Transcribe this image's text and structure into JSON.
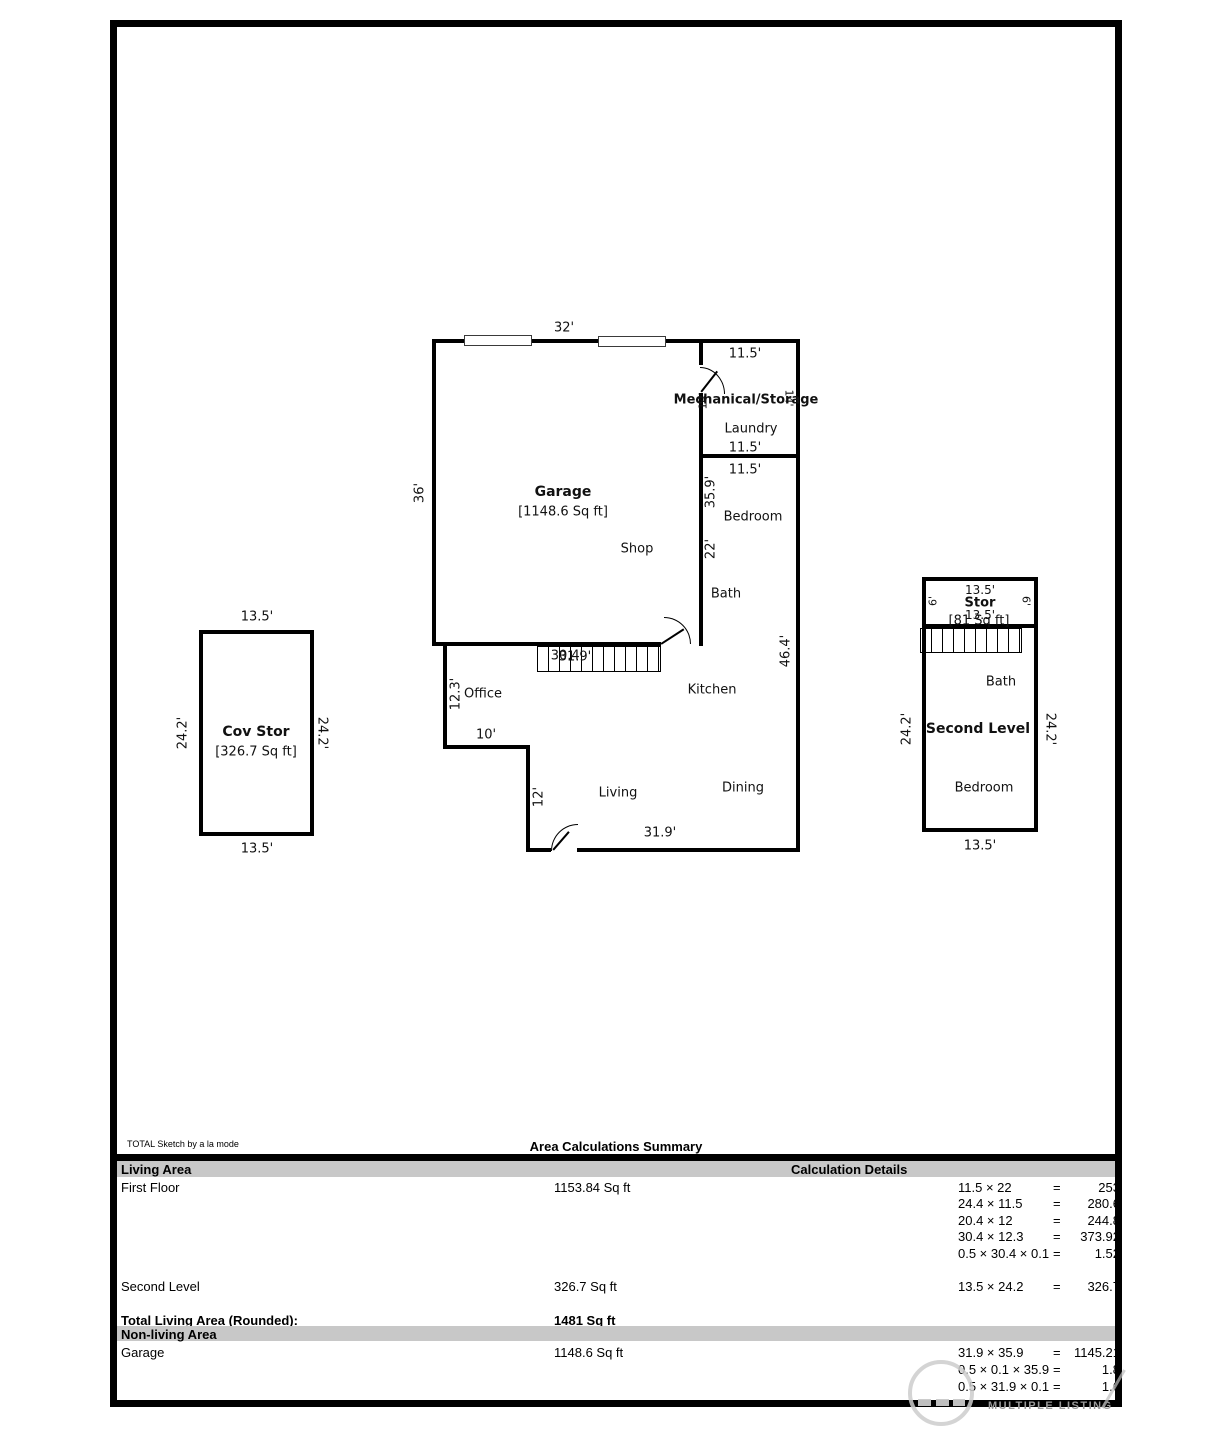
{
  "plan": {
    "garage": {
      "top_dim": "32'",
      "left_dim": "36'",
      "name": "Garage",
      "area": "[1148.6 Sq ft]",
      "shop_label": "Shop"
    },
    "mech_room": {
      "top_dim": "11.5'",
      "name": "Mechanical/Storage",
      "left_dim": "14'",
      "right_dim": "14'",
      "laundry_label": "Laundry",
      "bottom_dim": "11.5'"
    },
    "bedroom_wing": {
      "top_dim": "11.5'",
      "upper_wall_dim": "35.9'",
      "bedroom_label": "Bedroom",
      "lower_wall_dim": "22'",
      "bath_label": "Bath",
      "right_wall_dim": "46.4'",
      "kitchen_label": "Kitchen"
    },
    "stairs": {
      "dim_a": "30.4'",
      "dim_b": "31.9'"
    },
    "living_wing": {
      "office_label": "Office",
      "office_dim": "12.3'",
      "notch_dim": "10'",
      "step_dim": "12'",
      "living_label": "Living",
      "dining_label": "Dining",
      "bottom_dim": "31.9'"
    }
  },
  "cov_stor": {
    "top_dim": "13.5'",
    "name": "Cov Stor",
    "area": "[326.7 Sq ft]",
    "left_dim": "24.2'",
    "right_dim": "24.2'",
    "bottom_dim": "13.5'"
  },
  "second_level": {
    "stor": {
      "top_dim": "13.5'",
      "name": "Stor",
      "bottom_dim": "13.5'",
      "area": "[81 Sq ft]",
      "left_dim": "6'",
      "right_dim": "6'"
    },
    "bath_label": "Bath",
    "name": "Second Level",
    "bedroom_label": "Bedroom",
    "left_dim": "24.2'",
    "right_dim": "24.2'",
    "bottom_dim": "13.5'"
  },
  "summary": {
    "credit": "TOTAL Sketch by a la mode",
    "title": "Area Calculations Summary",
    "living_header": "Living Area",
    "calc_header": "Calculation Details",
    "eq": "=",
    "first_floor": {
      "label": "First Floor",
      "area": "1153.84 Sq ft"
    },
    "second_level_row": {
      "label": "Second Level",
      "area": "326.7 Sq ft"
    },
    "total_row": {
      "label": "Total Living Area (Rounded):",
      "area": "1481 Sq ft"
    },
    "nonliving_header": "Non-living Area",
    "garage_row": {
      "label": "Garage",
      "area": "1148.6 Sq ft"
    },
    "calcs_first_floor": [
      {
        "expr": "11.5 × 22",
        "result": "253"
      },
      {
        "expr": "24.4 × 11.5",
        "result": "280.6"
      },
      {
        "expr": "20.4 × 12",
        "result": "244.8"
      },
      {
        "expr": "30.4 × 12.3",
        "result": "373.92"
      },
      {
        "expr": "0.5 × 30.4 × 0.1",
        "result": "1.52"
      }
    ],
    "calcs_second_level": [
      {
        "expr": "13.5 × 24.2",
        "result": "326.7"
      }
    ],
    "calcs_garage": [
      {
        "expr": "31.9 × 35.9",
        "result": "1145.21"
      },
      {
        "expr": "0.5 × 0.1 × 35.9",
        "result": "1.8"
      },
      {
        "expr": "0.5 × 31.9 × 0.1",
        "result": "1.6"
      }
    ]
  },
  "watermark": {
    "text": "MULTIPLE LISTING"
  },
  "colors": {
    "wall": "#000000",
    "header_band": "#c8c8c8",
    "watermark_gray": "#c9c9c9"
  }
}
